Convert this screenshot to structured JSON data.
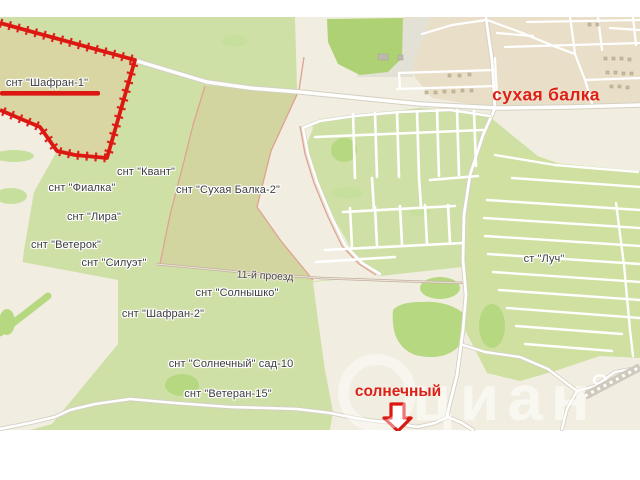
{
  "map": {
    "settlement_labels": [
      {
        "id": "shafran-1",
        "text": "снт \"Шафран-1\""
      },
      {
        "id": "kvant",
        "text": "снт \"Квант\""
      },
      {
        "id": "fialka",
        "text": "снт \"Фиалка\""
      },
      {
        "id": "lira",
        "text": "снт \"Лира\""
      },
      {
        "id": "veterok",
        "text": "снт \"Ветерок\""
      },
      {
        "id": "siluet",
        "text": "снт \"Силуэт\""
      },
      {
        "id": "suhaya-balka-2",
        "text": "снт \"Сухая Балка-2\""
      },
      {
        "id": "solnyshko",
        "text": "снт \"Солнышко\""
      },
      {
        "id": "shafran-2",
        "text": "снт \"Шафран-2\""
      },
      {
        "id": "solnechny-sad",
        "text": "снт \"Солнечный\" сад-10"
      },
      {
        "id": "veteran-15",
        "text": "снт \"Ветеран-15\""
      },
      {
        "id": "luch",
        "text": "ст \"Луч\""
      }
    ],
    "road_labels": [
      {
        "id": "proezd-11",
        "text": "11-й проезд"
      }
    ],
    "highlight_labels": [
      {
        "id": "suhaya-balka",
        "text": "сухая балка"
      },
      {
        "id": "solnechny",
        "text": "солнечный"
      }
    ],
    "watermark": "циан",
    "icons": {
      "entrance_pointer": "down-arrow-icon"
    },
    "colors": {
      "highlight_red": "#dd1a12",
      "label_text": "#3c3c3c",
      "greenery": "#cfe0a6",
      "grid_green": "#cfe0a1",
      "bright_green": "#aed173",
      "parcel_olive": "#d2d5a0",
      "parcel_tan": "#d9d6a3",
      "urban_beige": "#e9dec7",
      "open_ground": "#f1eee1",
      "road_fill": "#ffffff",
      "road_casing": "#d4d0c3",
      "boundary_pink": "#e0a292"
    }
  }
}
